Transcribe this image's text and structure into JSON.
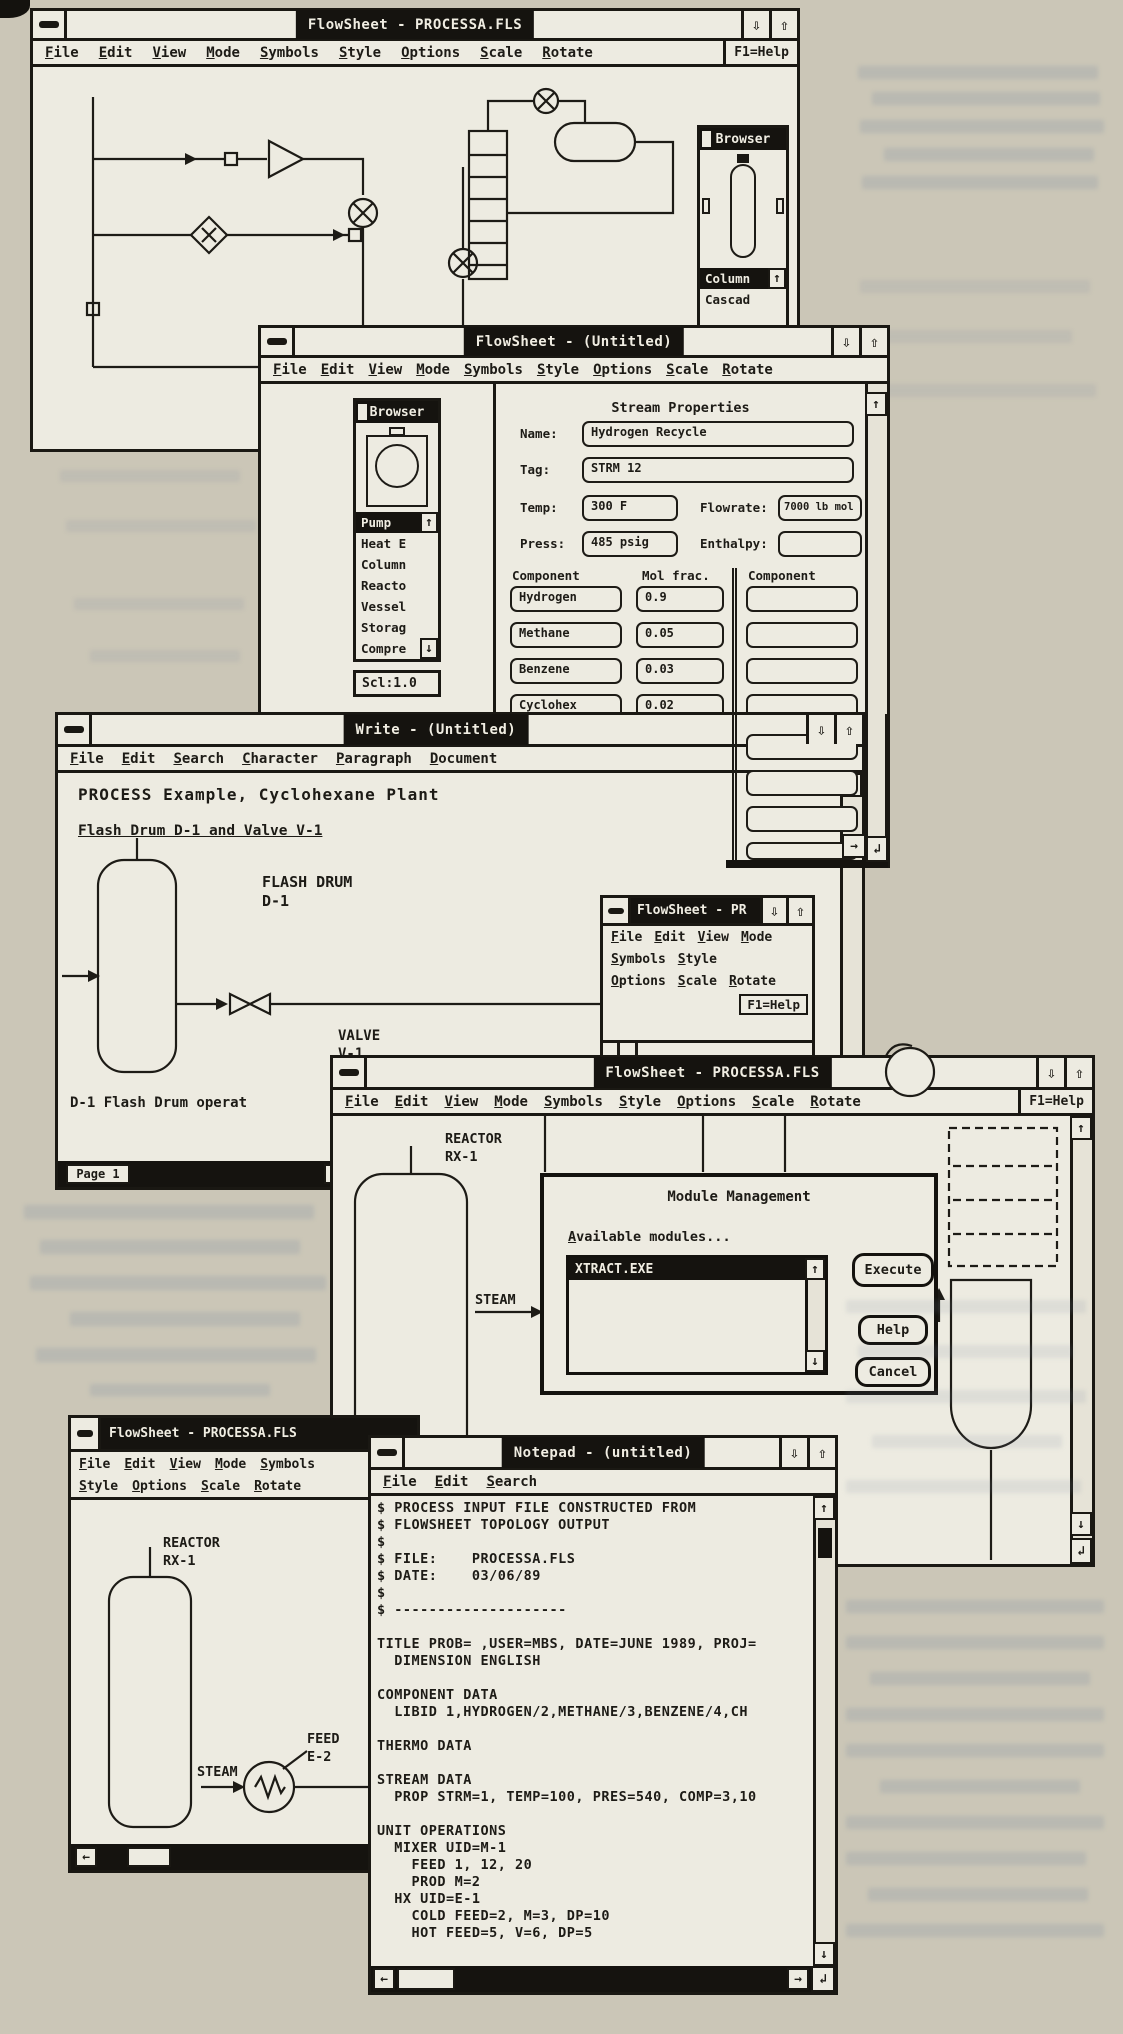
{
  "icons": {
    "minimize": "⇩",
    "maximize": "⇧",
    "up": "↑",
    "down": "↓",
    "left": "←",
    "right": "→",
    "corner": "↲"
  },
  "colors": {
    "ink": "#1d1b16",
    "paper": "#cbc6b7",
    "window": "#edebe1",
    "titlebar": "#15130f"
  },
  "flowsheet_menus": [
    "File",
    "Edit",
    "View",
    "Mode",
    "Symbols",
    "Style",
    "Options",
    "Scale",
    "Rotate"
  ],
  "help_label": "F1=Help",
  "win1": {
    "title": "FlowSheet - PROCESSA.FLS",
    "browser": {
      "title": "Browser",
      "items": [
        "Column",
        "Cascad"
      ]
    }
  },
  "win2": {
    "title": "FlowSheet - (Untitled)",
    "browser": {
      "title": "Browser",
      "items": [
        "Pump",
        "Heat E",
        "Column",
        "Reacto",
        "Vessel",
        "Storag",
        "Compre"
      ],
      "scale": "Scl:1.0"
    },
    "stream": {
      "heading": "Stream Properties",
      "name_label": "Name:",
      "name": "Hydrogen Recycle",
      "tag_label": "Tag:",
      "tag": "STRM 12",
      "temp_label": "Temp:",
      "temp": "300 F",
      "flow_label": "Flowrate:",
      "flow": "7000 lb mol",
      "press_label": "Press:",
      "press": "485 psig",
      "enth_label": "Enthalpy:",
      "enth": "",
      "col_headers": [
        "Component",
        "Mol frac.",
        "Component",
        "Mol frac."
      ],
      "components": [
        {
          "name": "Hydrogen",
          "frac": "0.9"
        },
        {
          "name": "Methane",
          "frac": "0.05"
        },
        {
          "name": "Benzene",
          "frac": "0.03"
        },
        {
          "name": "Cyclohex",
          "frac": "0.02"
        }
      ]
    }
  },
  "win3": {
    "title": "Write - (Untitled)",
    "menus": [
      "File",
      "Edit",
      "Search",
      "Character",
      "Paragraph",
      "Document"
    ],
    "doc": {
      "heading": "PROCESS Example, Cyclohexane Plant",
      "subheading": "Flash Drum D-1 and Valve V-1",
      "drum_label": "FLASH DRUM\nD-1",
      "valve_label": "VALVE\nV-1",
      "caption": "D-1 Flash Drum operat",
      "page_status": "Page 1"
    }
  },
  "win4": {
    "title": "FlowSheet - PR",
    "menu_row1": [
      "File",
      "Edit",
      "View",
      "Mode"
    ],
    "menu_row2": [
      "Symbols",
      "Style"
    ],
    "menu_row3": [
      "Options",
      "Scale",
      "Rotate"
    ]
  },
  "win5": {
    "title": "FlowSheet - PROCESSA.FLS",
    "reactor_label": "REACTOR\nRX-1",
    "steam_label": "STEAM",
    "dialog": {
      "title": "Module Management",
      "list_label": "Available modules...",
      "modules": [
        "XTRACT.EXE"
      ],
      "execute": "Execute",
      "help": "Help",
      "cancel": "Cancel"
    }
  },
  "win6": {
    "title": "FlowSheet - PROCESSA.FLS",
    "reactor_label": "REACTOR\nRX-1",
    "steam_label": "STEAM",
    "feed_label": "FEED\nE-2"
  },
  "win7": {
    "title": "Notepad - (untitled)",
    "menus": [
      "File",
      "Edit",
      "Search"
    ],
    "text": "$ PROCESS INPUT FILE CONSTRUCTED FROM\n$ FLOWSHEET TOPOLOGY OUTPUT\n$\n$ FILE:    PROCESSA.FLS\n$ DATE:    03/06/89\n$\n$ --------------------\n\nTITLE PROB= ,USER=MBS, DATE=JUNE 1989, PROJ=\n  DIMENSION ENGLISH\n\nCOMPONENT DATA\n  LIBID 1,HYDROGEN/2,METHANE/3,BENZENE/4,CH\n\nTHERMO DATA\n\nSTREAM DATA\n  PROP STRM=1, TEMP=100, PRES=540, COMP=3,10\n\nUNIT OPERATIONS\n  MIXER UID=M-1\n    FEED 1, 12, 20\n    PROD M=2\n  HX UID=E-1\n    COLD FEED=2, M=3, DP=10\n    HOT FEED=5, V=6, DP=5"
  }
}
